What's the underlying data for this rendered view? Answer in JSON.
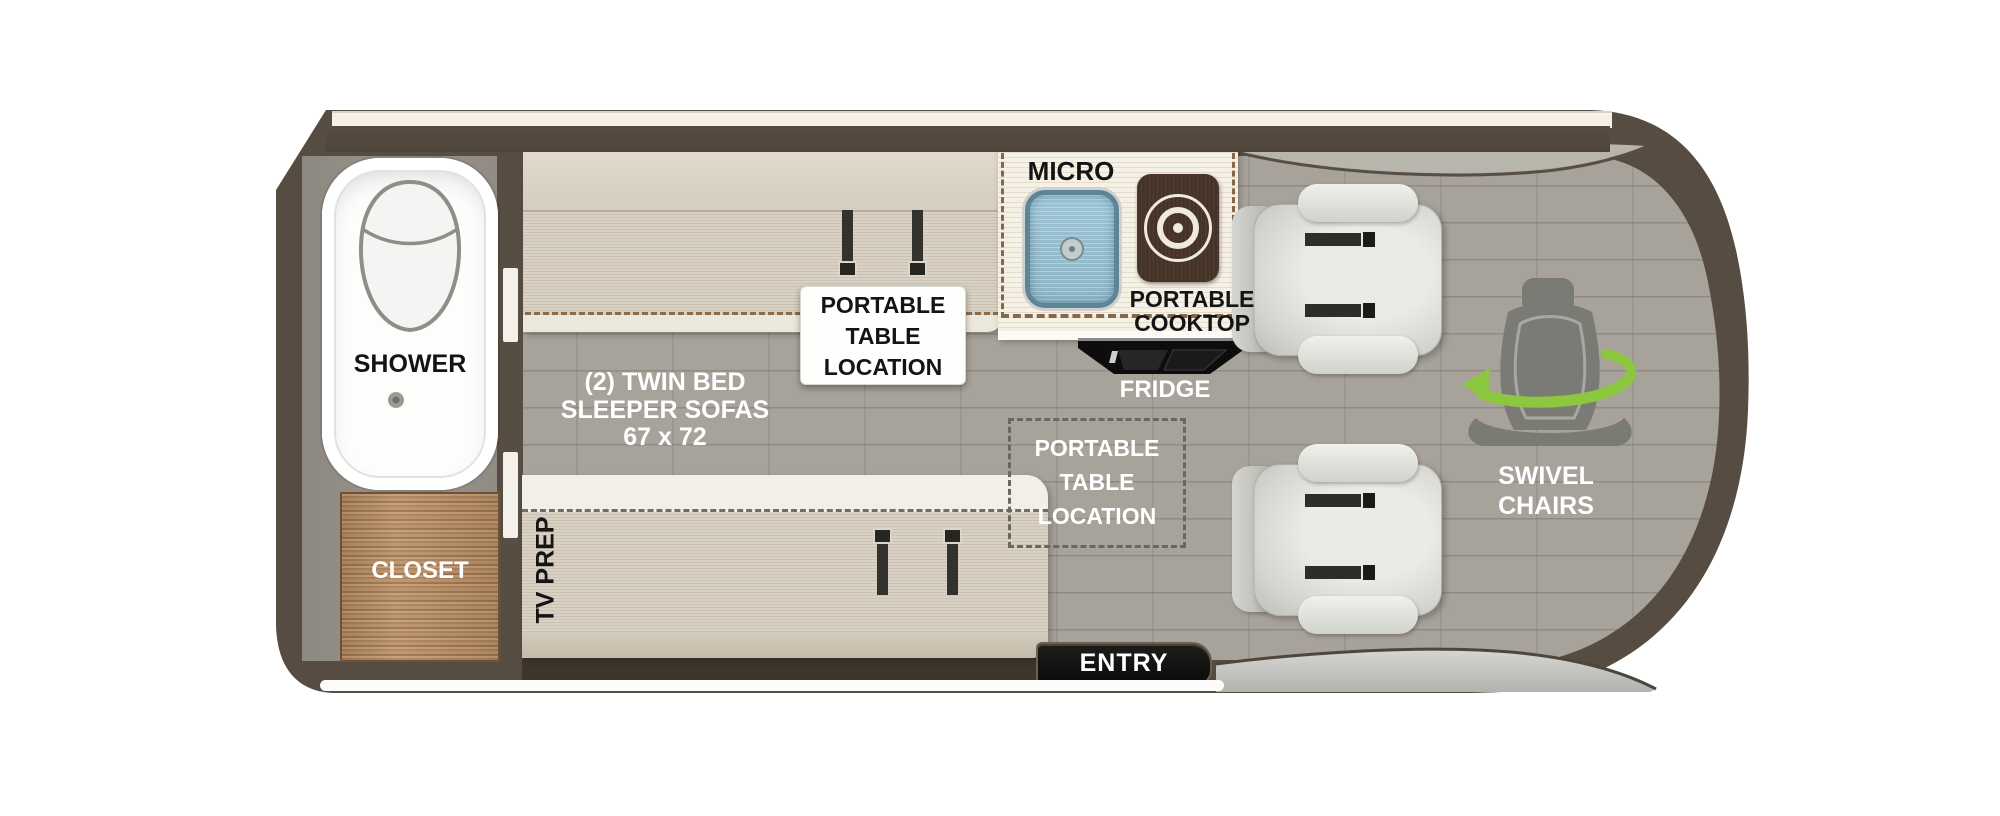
{
  "rooms": {
    "shower": {
      "label": "SHOWER"
    },
    "closet": {
      "label": "CLOSET"
    },
    "tv_prep": {
      "label": "TV PREP"
    },
    "sofas": {
      "line1": "(2) TWIN BED",
      "line2": "SLEEPER SOFAS",
      "line3": "67 x 72"
    },
    "portable_table": {
      "line1": "PORTABLE",
      "line2": "TABLE",
      "line3": "LOCATION"
    },
    "kitchen": {
      "micro": "MICRO",
      "cooktop_line1": "PORTABLE",
      "cooktop_line2": "COOKTOP",
      "fridge": "FRIDGE"
    },
    "swivel": {
      "line1": "SWIVEL",
      "line2": "CHAIRS"
    },
    "entry": {
      "label": "ENTRY"
    }
  },
  "colors": {
    "wall": "#584d42",
    "floor": "#a7a29a",
    "cream": "#f5f1e7",
    "wood": "#b58c63",
    "sofa": "#d9d1c3",
    "green": "#8dc63f",
    "sink": "#9ec4d4",
    "label-dark": "#141414",
    "label-light": "#ffffff"
  }
}
